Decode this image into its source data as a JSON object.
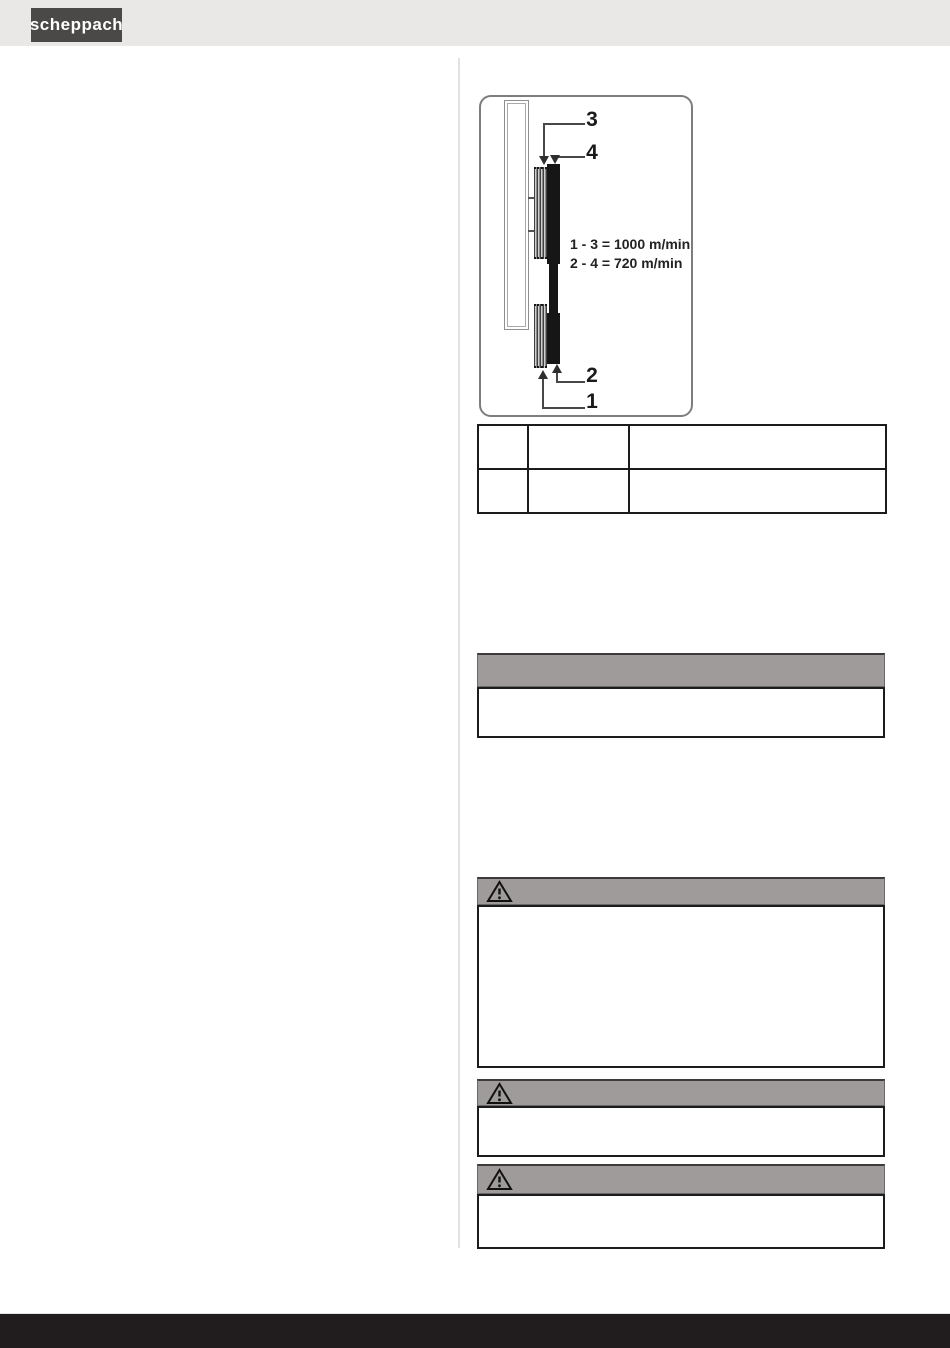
{
  "header": {
    "brand_logo_text": "scheppach"
  },
  "diagram": {
    "callout_labels": {
      "c3": "3",
      "c4": "4",
      "c2": "2",
      "c1": "1"
    },
    "speed_lines": [
      "1 - 3 = 1000 m/min",
      "2 - 4 = 720 m/min"
    ]
  },
  "parts_table": {
    "rows": [
      {
        "c1": "",
        "c2": "",
        "c3": ""
      },
      {
        "c1": "",
        "c2": "",
        "c3": ""
      }
    ]
  },
  "notices": {
    "plain": {
      "header_text": "",
      "body_text": ""
    },
    "warnings": [
      {
        "icon": "warning-triangle-icon",
        "header_text": "",
        "body_text": ""
      },
      {
        "icon": "warning-triangle-icon",
        "header_text": "",
        "body_text": ""
      },
      {
        "icon": "warning-triangle-icon",
        "header_text": "",
        "body_text": ""
      }
    ]
  },
  "colors": {
    "page_header_bg": "#e9e8e7",
    "logo_bg": "#4b4947",
    "notice_header_bg": "#9e9b9a",
    "footer_bg": "#211d1e",
    "belt_black": "#161616"
  }
}
